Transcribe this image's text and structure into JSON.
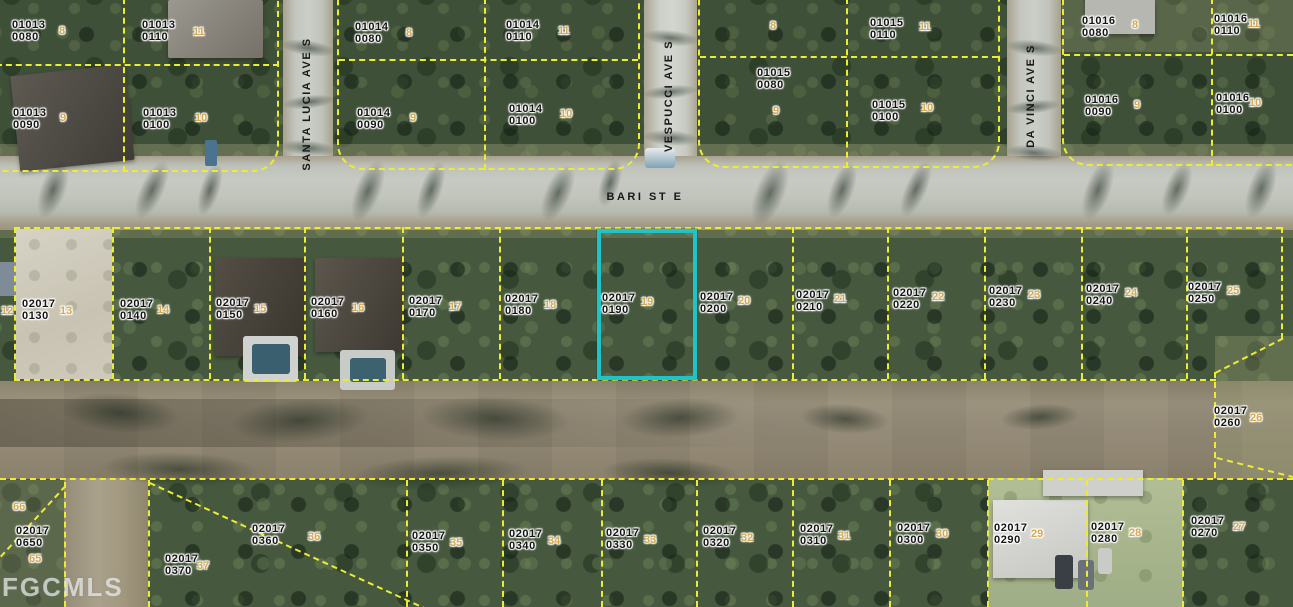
{
  "map": {
    "watermark": "FGCMLS",
    "streets": [
      {
        "label": "BARI ST E",
        "x": 645,
        "y": 197,
        "vertical": false
      },
      {
        "label": "SANTA LUCIA AVE S",
        "x": 307,
        "y": 104,
        "vertical": true
      },
      {
        "label": "VESPUCCI AVE S",
        "x": 669,
        "y": 96,
        "vertical": true
      },
      {
        "label": "DA VINCI AVE S",
        "x": 1031,
        "y": 96,
        "vertical": true
      }
    ],
    "highlight": {
      "parcel": "02017 0190",
      "x": 597,
      "y": 229,
      "width": 100,
      "height": 151
    },
    "parcel_id_labels": [
      {
        "line1": "01013",
        "line2": "0080",
        "x": 12,
        "y": 20
      },
      {
        "line1": "01013",
        "line2": "0110",
        "x": 142,
        "y": 20
      },
      {
        "line1": "01013",
        "line2": "0090",
        "x": 13,
        "y": 108
      },
      {
        "line1": "01013",
        "line2": "0100",
        "x": 143,
        "y": 108
      },
      {
        "line1": "01014",
        "line2": "0080",
        "x": 355,
        "y": 22
      },
      {
        "line1": "01014",
        "line2": "0090",
        "x": 357,
        "y": 108
      },
      {
        "line1": "01014",
        "line2": "0110",
        "x": 506,
        "y": 20
      },
      {
        "line1": "01014",
        "line2": "0100",
        "x": 509,
        "y": 104
      },
      {
        "line1": "01015",
        "line2": "0080",
        "x": 757,
        "y": 68
      },
      {
        "line1": "01015",
        "line2": "0110",
        "x": 870,
        "y": 18
      },
      {
        "line1": "01015",
        "line2": "0100",
        "x": 872,
        "y": 100
      },
      {
        "line1": "01016",
        "line2": "0080",
        "x": 1082,
        "y": 16
      },
      {
        "line1": "01016",
        "line2": "0090",
        "x": 1085,
        "y": 95
      },
      {
        "line1": "01016",
        "line2": "0110",
        "x": 1214,
        "y": 14
      },
      {
        "line1": "01016",
        "line2": "0100",
        "x": 1216,
        "y": 93
      },
      {
        "line1": "02017",
        "line2": "0130",
        "x": 22,
        "y": 299
      },
      {
        "line1": "02017",
        "line2": "0140",
        "x": 120,
        "y": 299
      },
      {
        "line1": "02017",
        "line2": "0150",
        "x": 216,
        "y": 298
      },
      {
        "line1": "02017",
        "line2": "0160",
        "x": 311,
        "y": 297
      },
      {
        "line1": "02017",
        "line2": "0170",
        "x": 409,
        "y": 296
      },
      {
        "line1": "02017",
        "line2": "0180",
        "x": 505,
        "y": 294
      },
      {
        "line1": "02017",
        "line2": "0190",
        "x": 602,
        "y": 293
      },
      {
        "line1": "02017",
        "line2": "0200",
        "x": 700,
        "y": 292
      },
      {
        "line1": "02017",
        "line2": "0210",
        "x": 796,
        "y": 290
      },
      {
        "line1": "02017",
        "line2": "0220",
        "x": 893,
        "y": 288
      },
      {
        "line1": "02017",
        "line2": "0230",
        "x": 989,
        "y": 286
      },
      {
        "line1": "02017",
        "line2": "0240",
        "x": 1086,
        "y": 284
      },
      {
        "line1": "02017",
        "line2": "0250",
        "x": 1188,
        "y": 282
      },
      {
        "line1": "02017",
        "line2": "0260",
        "x": 1214,
        "y": 406
      },
      {
        "line1": "02017",
        "line2": "0650",
        "x": 16,
        "y": 526
      },
      {
        "line1": "02017",
        "line2": "0370",
        "x": 165,
        "y": 554
      },
      {
        "line1": "02017",
        "line2": "0360",
        "x": 252,
        "y": 524
      },
      {
        "line1": "02017",
        "line2": "0350",
        "x": 412,
        "y": 531
      },
      {
        "line1": "02017",
        "line2": "0340",
        "x": 509,
        "y": 529
      },
      {
        "line1": "02017",
        "line2": "0330",
        "x": 606,
        "y": 528
      },
      {
        "line1": "02017",
        "line2": "0320",
        "x": 703,
        "y": 526
      },
      {
        "line1": "02017",
        "line2": "0310",
        "x": 800,
        "y": 524
      },
      {
        "line1": "02017",
        "line2": "0300",
        "x": 897,
        "y": 523
      },
      {
        "line1": "02017",
        "line2": "0290",
        "x": 994,
        "y": 523
      },
      {
        "line1": "02017",
        "line2": "0280",
        "x": 1091,
        "y": 522
      },
      {
        "line1": "02017",
        "line2": "0270",
        "x": 1191,
        "y": 516
      }
    ],
    "lot_markers": [
      {
        "text": "8",
        "x": 59,
        "y": 25
      },
      {
        "text": "11",
        "x": 193,
        "y": 26
      },
      {
        "text": "9",
        "x": 60,
        "y": 112
      },
      {
        "text": "10",
        "x": 195,
        "y": 112
      },
      {
        "text": "8",
        "x": 406,
        "y": 27
      },
      {
        "text": "9",
        "x": 410,
        "y": 112
      },
      {
        "text": "11",
        "x": 558,
        "y": 25
      },
      {
        "text": "10",
        "x": 560,
        "y": 108
      },
      {
        "text": "8",
        "x": 770,
        "y": 20
      },
      {
        "text": "9",
        "x": 773,
        "y": 105
      },
      {
        "text": "11",
        "x": 919,
        "y": 21
      },
      {
        "text": "10",
        "x": 921,
        "y": 102
      },
      {
        "text": "8",
        "x": 1132,
        "y": 19
      },
      {
        "text": "9",
        "x": 1134,
        "y": 99
      },
      {
        "text": "11",
        "x": 1248,
        "y": 18
      },
      {
        "text": "10",
        "x": 1249,
        "y": 97
      },
      {
        "text": "12",
        "x": 1,
        "y": 305
      },
      {
        "text": "13",
        "x": 60,
        "y": 305
      },
      {
        "text": "14",
        "x": 157,
        "y": 304
      },
      {
        "text": "15",
        "x": 254,
        "y": 303
      },
      {
        "text": "16",
        "x": 352,
        "y": 302
      },
      {
        "text": "17",
        "x": 449,
        "y": 301
      },
      {
        "text": "18",
        "x": 544,
        "y": 299
      },
      {
        "text": "19",
        "x": 641,
        "y": 296
      },
      {
        "text": "20",
        "x": 738,
        "y": 295
      },
      {
        "text": "21",
        "x": 834,
        "y": 293
      },
      {
        "text": "22",
        "x": 932,
        "y": 291
      },
      {
        "text": "23",
        "x": 1028,
        "y": 289
      },
      {
        "text": "24",
        "x": 1125,
        "y": 287
      },
      {
        "text": "25",
        "x": 1227,
        "y": 285
      },
      {
        "text": "26",
        "x": 1250,
        "y": 412
      },
      {
        "text": "66",
        "x": 13,
        "y": 501
      },
      {
        "text": "65",
        "x": 29,
        "y": 553
      },
      {
        "text": "37",
        "x": 197,
        "y": 560
      },
      {
        "text": "36",
        "x": 308,
        "y": 531
      },
      {
        "text": "35",
        "x": 450,
        "y": 537
      },
      {
        "text": "34",
        "x": 548,
        "y": 535
      },
      {
        "text": "33",
        "x": 644,
        "y": 534
      },
      {
        "text": "32",
        "x": 741,
        "y": 532
      },
      {
        "text": "31",
        "x": 838,
        "y": 530
      },
      {
        "text": "30",
        "x": 936,
        "y": 528
      },
      {
        "text": "29",
        "x": 1031,
        "y": 528
      },
      {
        "text": "28",
        "x": 1129,
        "y": 527
      },
      {
        "text": "27",
        "x": 1233,
        "y": 521
      }
    ]
  },
  "colors": {
    "boundary_yellow": "#ecec33",
    "highlight_cyan": "#1fc4c9",
    "lot_number_gold": "#d7a94c",
    "label_black": "#141414",
    "watermark_white": "#ffffff"
  }
}
